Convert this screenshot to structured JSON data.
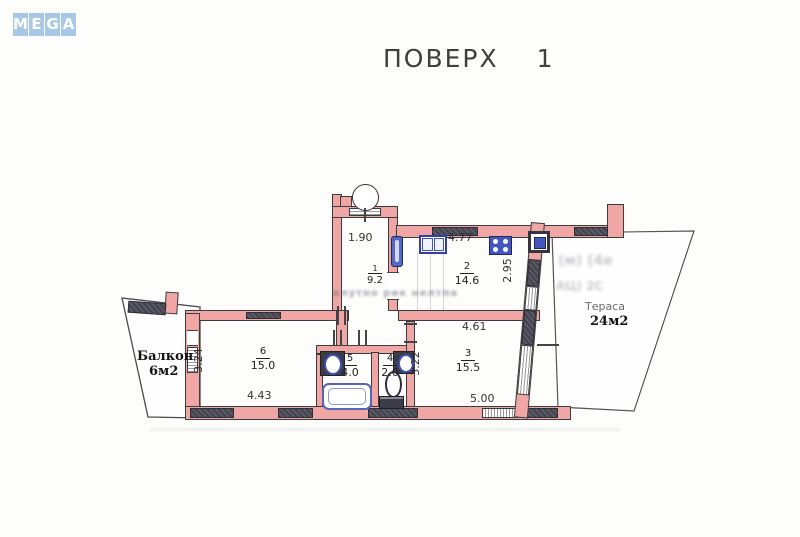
{
  "logo": {
    "letters": [
      "M",
      "E",
      "G",
      "A"
    ]
  },
  "title": {
    "text": "ПОВЕРХ",
    "number": "1"
  },
  "plan": {
    "rooms": [
      {
        "number": "1",
        "area": "9.2",
        "width_dim": "1.90"
      },
      {
        "number": "2",
        "area": "14.6",
        "top_dim": "4.77",
        "right_dim": "2.95"
      },
      {
        "number": "3",
        "area": "15.5",
        "top_dim": "4.61",
        "left_dim": "3.22",
        "bottom_dim": "5.00"
      },
      {
        "number": "4",
        "area": "2.0"
      },
      {
        "number": "5",
        "area": "4.0"
      },
      {
        "number": "6",
        "area": "15.0",
        "left_dim": "3.24",
        "bottom_dim": "4.43"
      }
    ],
    "balcony": {
      "label": "Балкон",
      "area": "6м2"
    },
    "terrace": {
      "label": "Тераса",
      "area": "24м2"
    }
  },
  "watermark": {
    "center": "влутно  рик нелтпа",
    "bleed_line1": "(м)  (4е",
    "bleed_line2": "АЦ)  2С"
  },
  "colors": {
    "wall_pink": "#f1a6a6",
    "window_dark": "#4d4d58",
    "fixture_blue": "#4456c0",
    "logo_blue": "#a7c9e7",
    "title_gray": "#3f3f3f"
  }
}
